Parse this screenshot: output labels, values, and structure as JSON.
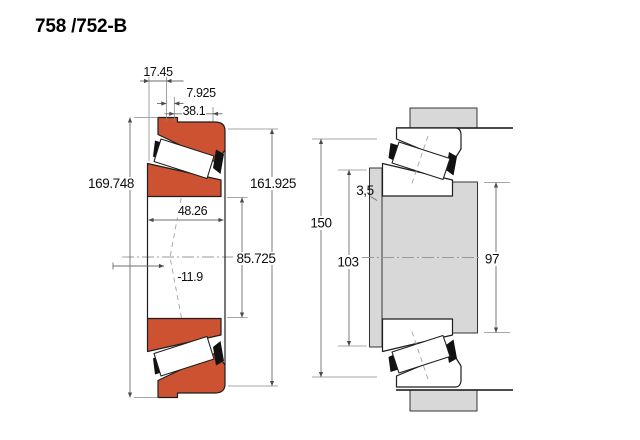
{
  "title": "758 /752-B",
  "colors": {
    "bearing_ring_fill": "#cd5232",
    "steel_section_fill": "#d8d8d8",
    "outline": "#1e1e1e",
    "dimension_line": "#6f6f6f",
    "text": "#0d0d0d",
    "background": "#ffffff"
  },
  "left_view": {
    "description": "tapered roller bearing cross-section",
    "dims": {
      "flange_width": "17.45",
      "flange_step": "7.925",
      "cup_width": "38.1",
      "flange_diameter": "169.748",
      "outer_diameter": "161.925",
      "cone_width": "48.26",
      "bore_diameter": "85.725",
      "effective_load_center": "-11.9"
    }
  },
  "right_view": {
    "description": "mounted bearing abutment dimensions",
    "dims": {
      "housing_shoulder_diameter": "150",
      "shaft_abutment_diameter": "103",
      "fillet": "3,5",
      "backing_shoulder_diameter": "97"
    }
  }
}
